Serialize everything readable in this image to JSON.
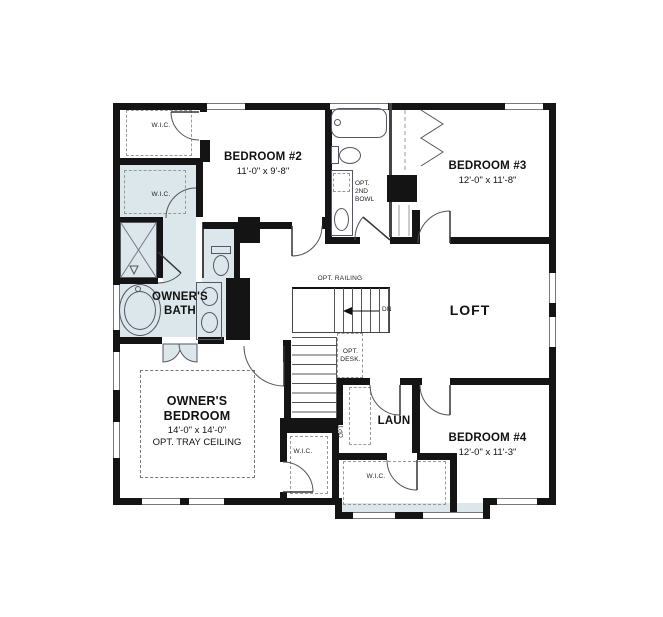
{
  "colors": {
    "wall": "#141414",
    "room_shading": "#dbe7ea",
    "fixture_line": "#555566",
    "dashed_line": "#999999",
    "background": "#ffffff"
  },
  "rooms": {
    "bedroom2": {
      "name": "BEDROOM #2",
      "dims": "11'-0\" x 9'-8\""
    },
    "bedroom3": {
      "name": "BEDROOM #3",
      "dims": "12'-0\" x 11'-8\""
    },
    "bedroom4": {
      "name": "BEDROOM #4",
      "dims": "12'-0\" x 11'-3\""
    },
    "owners_bedroom": {
      "name": "OWNER'S BEDROOM",
      "dims": "14'-0\" x 14'-0\"",
      "note": "OPT. TRAY CEILING"
    },
    "owners_bath": {
      "name": "OWNER'S BATH"
    },
    "loft": {
      "name": "LOFT"
    },
    "laundry": {
      "name": "LAUN"
    }
  },
  "annotations": {
    "wic": "W.I.C.",
    "opt_railing": "OPT. RAILING",
    "down": "DN",
    "opt_desk": "OPT. DESK.",
    "opt_cabinet": "OPT. CABINET",
    "opt_2nd_bowl": "OPT. 2ND BOWL"
  }
}
